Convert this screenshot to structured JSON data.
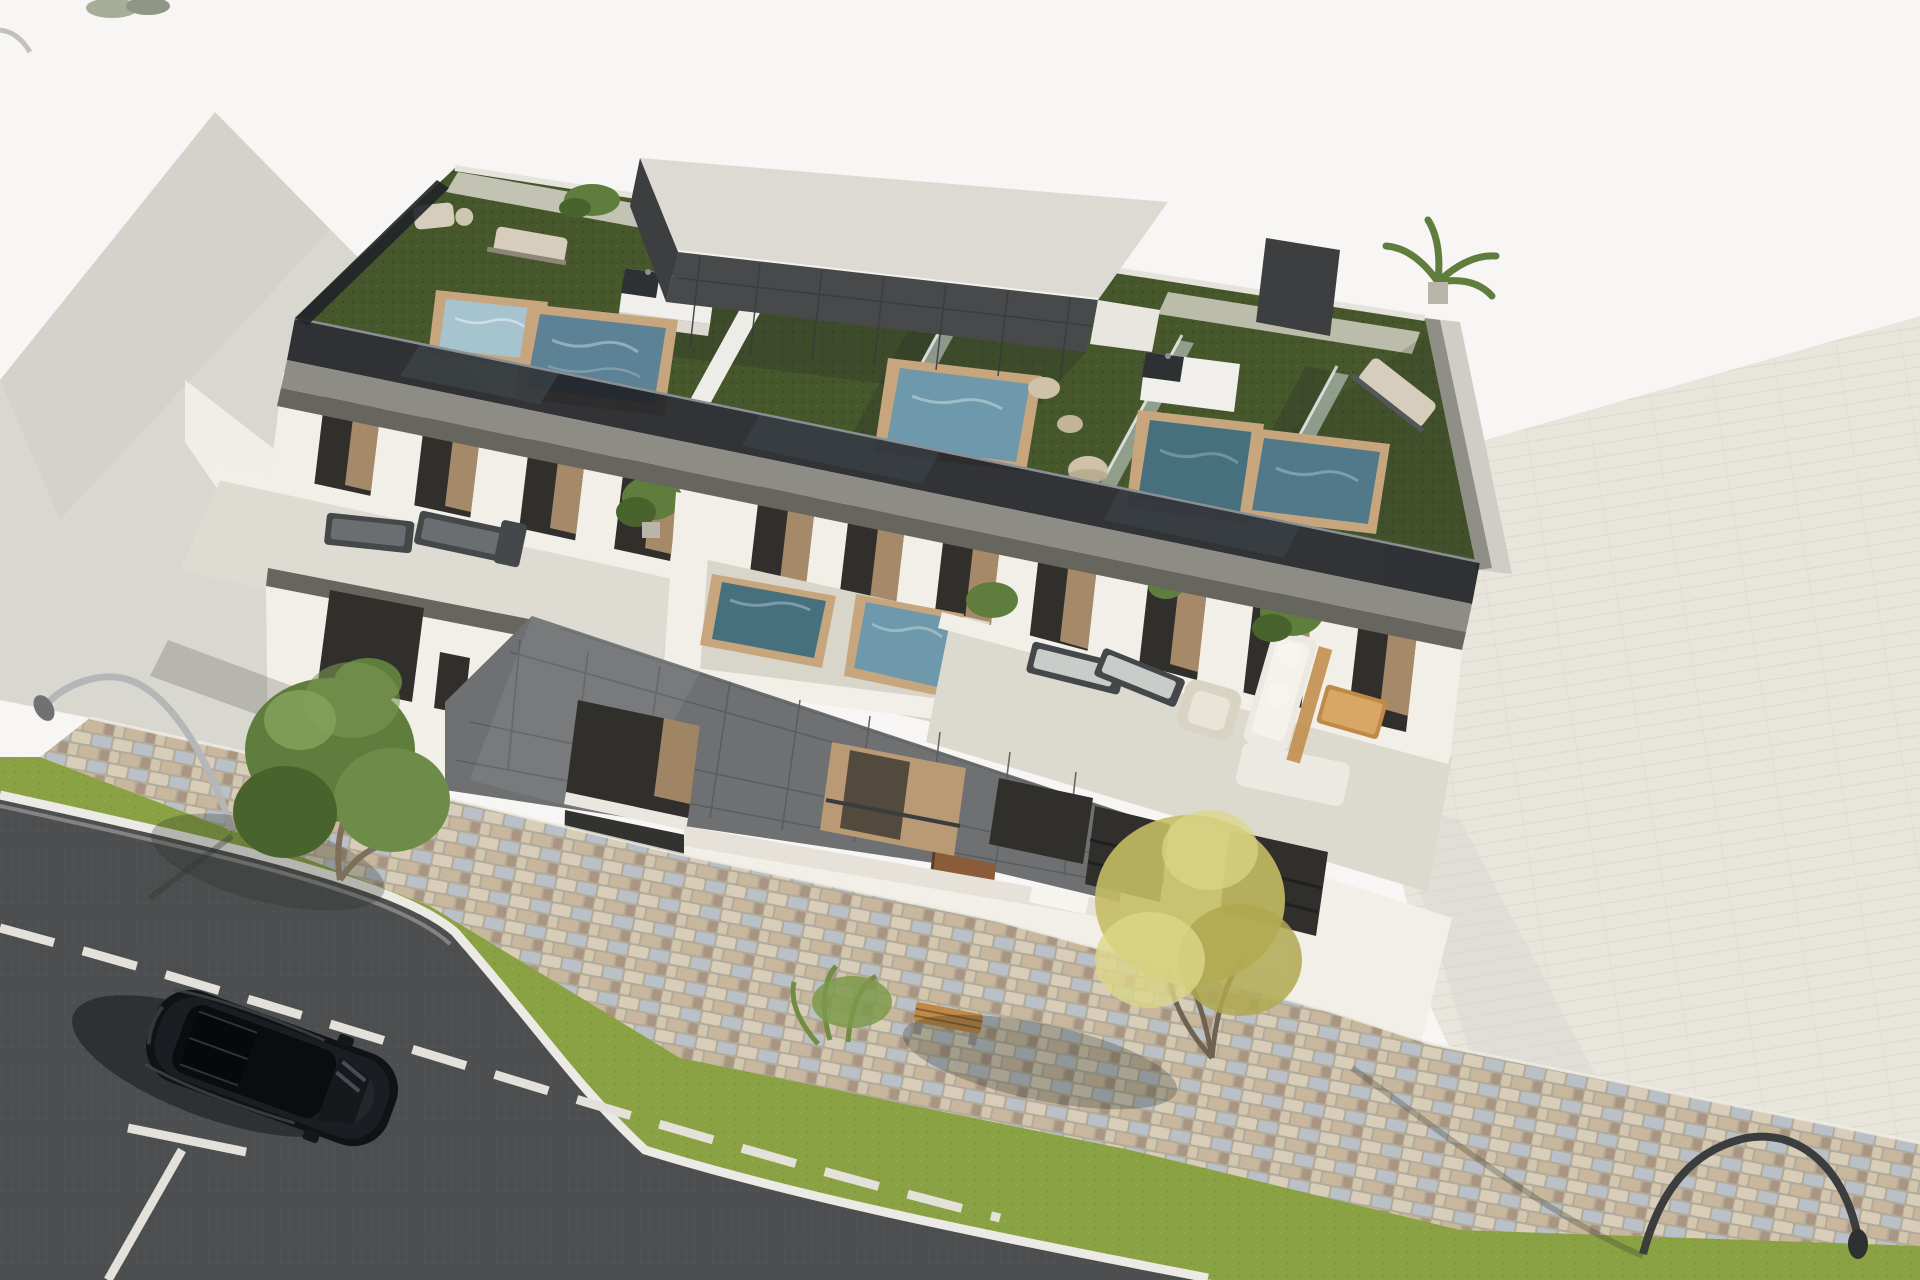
{
  "meta": {
    "type": "architectural-3d-render",
    "description": "Aerial 3D visualization of a modern flat-roofed apartment building with rooftop terraces (artificial turf, plunge pools with wooden rims, outdoor kitchens, glass dividers, dark tiled penthouse), second-floor terraces with jacuzzis and lounge furniture, a dark grey tiled facade volume, cobblestone sidewalk, grass verges with trees, curved street lamps, an asphalt road with white markings and a parked black SUV. No text appears in the image.",
    "width": 1920,
    "height": 1280
  },
  "scene": {
    "objects": [
      "neighbor-roof-plane",
      "sunlit-roof-wedge",
      "background-paving",
      "main-building",
      "penthouse",
      "roof-terrace-turf",
      "plunge-pools",
      "outdoor-kitchens",
      "glass-dividers",
      "roof-loungers",
      "decor-stones",
      "roof-plants",
      "second-floor-terraces",
      "jacuzzis",
      "outdoor-sofa-set",
      "coffee-table",
      "terrace-loungers",
      "tiled-facade-volume",
      "entrance-door",
      "facade-windows",
      "planter-boxes",
      "cobblestone-sidewalk",
      "grass-verge",
      "green-tree-left",
      "shrub-and-bench",
      "yellow-tree-right",
      "street-lamp-silver-left",
      "street-lamp-dark-right",
      "asphalt-road",
      "curb-line",
      "dashed-lane-line",
      "parking-bay-marking",
      "black-suv-top-view"
    ],
    "colors": {
      "sky": "#f7f6f4",
      "plane1": "#d9d8d0",
      "ground-bright": "#f0eee7",
      "paving": "#e7e5dc",
      "paving-line": "#d8d6cb",
      "asphalt": "#4d4e50",
      "asphalt-dot": "#5e5f61",
      "curb": "#eceae4",
      "road-mark": "#e3e1da",
      "grass": "#8aa243",
      "grass-dark": "#6f8836",
      "cobble-base": "#b3ab9a",
      "cob1": "#d7cdb9",
      "cob2": "#b9c0c7",
      "cob3": "#c9b79d",
      "cob4": "#a99581",
      "cob5": "#d2c6ae",
      "white-wall": "#f2efe9",
      "white-wall-shade": "#ddd9d0",
      "fascia-gray": "#8d8d85",
      "fascia-dark": "#66665f",
      "glass-dark": "#212428",
      "glass-reflect": "#434a4f",
      "tile-dark": "#6e7072",
      "tile-line": "#595b5d",
      "tile-darker": "#3c3e40",
      "penthouse-roof": "#dcdad2",
      "turf": "#46572c",
      "turf-dot": "#36451f",
      "window-dark": "#312f2c",
      "curtain": "#b3946f",
      "wood": "#c7a67e",
      "wood-dark": "#a8875f",
      "water1": "#a6c4cf",
      "water2": "#5d8195",
      "water3": "#6e98ab",
      "water4": "#47707f",
      "stone": "#cfc2a8",
      "kitchen-white": "#f0efeb",
      "counter-dark": "#2e3133",
      "sofa": "#ebe9e1",
      "wood-furn": "#c08947",
      "lounge-dark": "#45484a",
      "lounge-pad": "#d6cdbc",
      "tree-green": "#5f7d3c",
      "tree-green-dark": "#49632c",
      "tree-yellow": "#c4bc63",
      "tree-yellow-pale": "#dcd688",
      "trunk": "#7d6f5a",
      "lamp-silver": "#b4b6b7",
      "lamp-dark": "#3b3d3e",
      "car-black": "#101316",
      "car-glass": "#0a0c0e",
      "car-high": "#4a525a",
      "door-brown": "#8a5c39",
      "shadow": "rgba(40,45,38,0.28)",
      "shadow-strong": "rgba(12,14,13,0.45)"
    }
  }
}
